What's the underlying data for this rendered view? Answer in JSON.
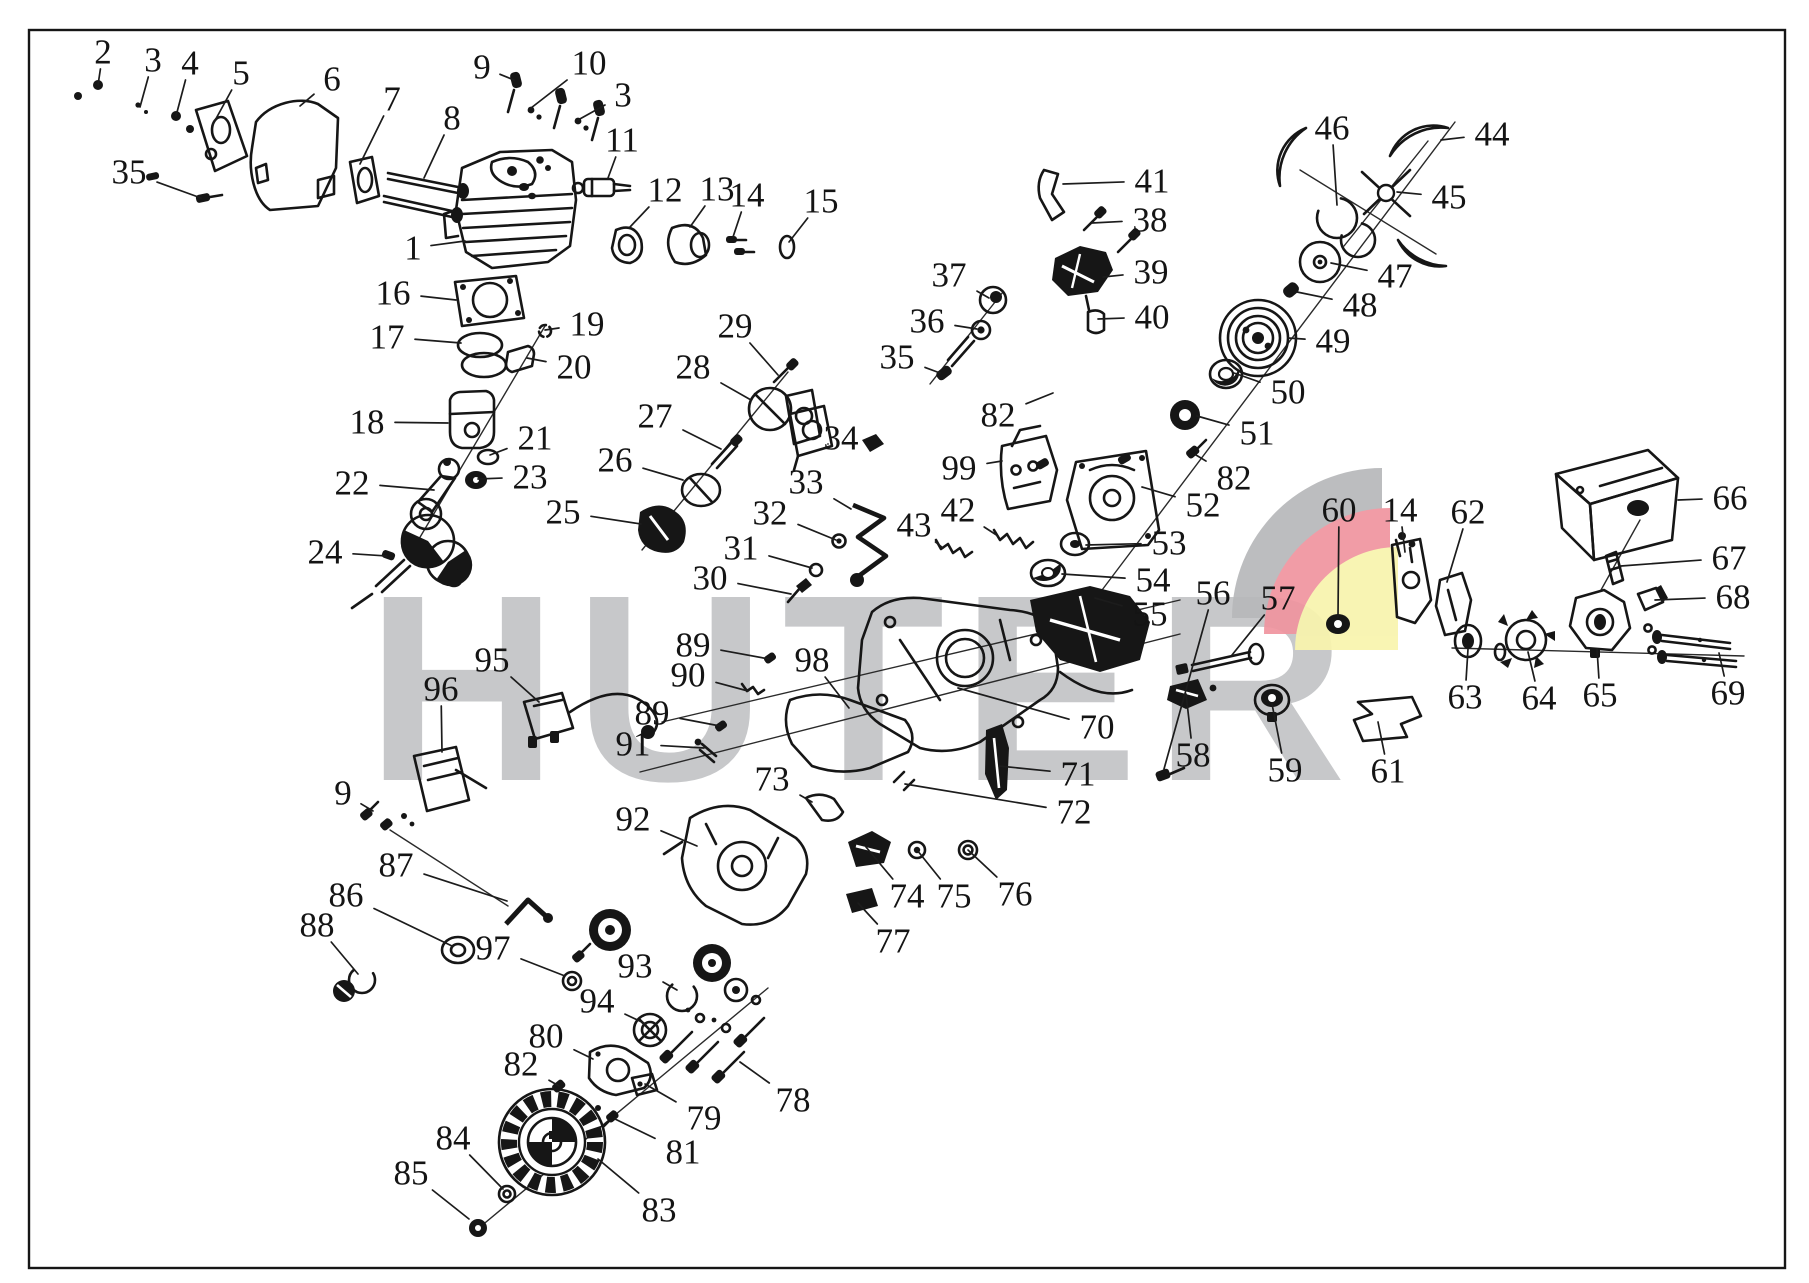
{
  "diagram": {
    "type": "exploded-parts-diagram",
    "subject": "chainsaw engine parts",
    "brand_watermark": "HUTER",
    "colors": {
      "background": "#ffffff",
      "line": "#161616",
      "watermark_gray": "#c7c8ca",
      "logo_gray": "#b7b8ba",
      "logo_red": "#f0949f",
      "logo_yellow": "#f8f4ad"
    },
    "labels": [
      {
        "n": "2",
        "x": 103,
        "y": 52,
        "tx": 98,
        "ty": 85
      },
      {
        "n": "3",
        "x": 153,
        "y": 60,
        "tx": 140,
        "ty": 107
      },
      {
        "n": "4",
        "x": 190,
        "y": 63,
        "tx": 176,
        "ty": 116
      },
      {
        "n": "5",
        "x": 241,
        "y": 73,
        "tx": 212,
        "ty": 126
      },
      {
        "n": "6",
        "x": 332,
        "y": 79,
        "tx": 300,
        "ty": 106
      },
      {
        "n": "7",
        "x": 392,
        "y": 99,
        "tx": 360,
        "ty": 164
      },
      {
        "n": "8",
        "x": 452,
        "y": 118,
        "tx": 424,
        "ty": 178
      },
      {
        "n": "9",
        "x": 482,
        "y": 67,
        "tx": 514,
        "ty": 80
      },
      {
        "n": "10",
        "x": 589,
        "y": 63,
        "tx": 531,
        "ty": 108
      },
      {
        "n": "3",
        "x": 623,
        "y": 95,
        "tx": 578,
        "ty": 120
      },
      {
        "n": "11",
        "x": 622,
        "y": 140,
        "tx": 608,
        "ty": 178
      },
      {
        "n": "35",
        "x": 129,
        "y": 172,
        "tx": 201,
        "ty": 198
      },
      {
        "n": "1",
        "x": 413,
        "y": 248,
        "tx": 465,
        "ty": 241
      },
      {
        "n": "12",
        "x": 665,
        "y": 190,
        "tx": 630,
        "ty": 227
      },
      {
        "n": "13",
        "x": 717,
        "y": 189,
        "tx": 690,
        "ty": 227
      },
      {
        "n": "14",
        "x": 747,
        "y": 195,
        "tx": 733,
        "ty": 237
      },
      {
        "n": "15",
        "x": 821,
        "y": 201,
        "tx": 789,
        "ty": 242
      },
      {
        "n": "16",
        "x": 393,
        "y": 293,
        "tx": 456,
        "ty": 300
      },
      {
        "n": "17",
        "x": 387,
        "y": 337,
        "tx": 461,
        "ty": 343
      },
      {
        "n": "19",
        "x": 587,
        "y": 324,
        "tx": 545,
        "ty": 330
      },
      {
        "n": "20",
        "x": 574,
        "y": 367,
        "tx": 527,
        "ty": 358
      },
      {
        "n": "18",
        "x": 367,
        "y": 422,
        "tx": 448,
        "ty": 423
      },
      {
        "n": "21",
        "x": 535,
        "y": 438,
        "tx": 490,
        "ty": 455
      },
      {
        "n": "23",
        "x": 530,
        "y": 477,
        "tx": 478,
        "ty": 479
      },
      {
        "n": "22",
        "x": 352,
        "y": 483,
        "tx": 434,
        "ty": 490
      },
      {
        "n": "24",
        "x": 325,
        "y": 552,
        "tx": 387,
        "ty": 556
      },
      {
        "n": "25",
        "x": 563,
        "y": 512,
        "tx": 641,
        "ty": 524
      },
      {
        "n": "26",
        "x": 615,
        "y": 460,
        "tx": 683,
        "ty": 480
      },
      {
        "n": "27",
        "x": 655,
        "y": 416,
        "tx": 721,
        "ty": 449
      },
      {
        "n": "28",
        "x": 693,
        "y": 367,
        "tx": 751,
        "ty": 400
      },
      {
        "n": "29",
        "x": 735,
        "y": 326,
        "tx": 778,
        "ty": 375
      },
      {
        "n": "34",
        "x": 841,
        "y": 438,
        "tx": 828,
        "ty": 444
      },
      {
        "n": "33",
        "x": 806,
        "y": 482,
        "tx": 851,
        "ty": 509
      },
      {
        "n": "32",
        "x": 770,
        "y": 513,
        "tx": 836,
        "ty": 540
      },
      {
        "n": "31",
        "x": 741,
        "y": 548,
        "tx": 812,
        "ty": 568
      },
      {
        "n": "30",
        "x": 710,
        "y": 578,
        "tx": 791,
        "ty": 594
      },
      {
        "n": "43",
        "x": 914,
        "y": 525,
        "tx": 943,
        "ty": 548
      },
      {
        "n": "42",
        "x": 958,
        "y": 510,
        "tx": 998,
        "ty": 536
      },
      {
        "n": "99",
        "x": 959,
        "y": 468,
        "tx": 1002,
        "ty": 461
      },
      {
        "n": "82",
        "x": 998,
        "y": 415,
        "tx": 1053,
        "ty": 393
      },
      {
        "n": "37",
        "x": 949,
        "y": 275,
        "tx": 989,
        "ty": 298
      },
      {
        "n": "36",
        "x": 927,
        "y": 321,
        "tx": 977,
        "ty": 329
      },
      {
        "n": "35",
        "x": 897,
        "y": 357,
        "tx": 940,
        "ty": 373
      },
      {
        "n": "41",
        "x": 1152,
        "y": 181,
        "tx": 1063,
        "ty": 184
      },
      {
        "n": "38",
        "x": 1150,
        "y": 220,
        "tx": 1092,
        "ty": 223
      },
      {
        "n": "39",
        "x": 1151,
        "y": 272,
        "tx": 1103,
        "ty": 277
      },
      {
        "n": "40",
        "x": 1152,
        "y": 317,
        "tx": 1098,
        "ty": 319
      },
      {
        "n": "46",
        "x": 1332,
        "y": 128,
        "tx": 1337,
        "ty": 205
      },
      {
        "n": "44",
        "x": 1492,
        "y": 134,
        "tx": 1441,
        "ty": 140
      },
      {
        "n": "45",
        "x": 1449,
        "y": 197,
        "tx": 1397,
        "ty": 192
      },
      {
        "n": "47",
        "x": 1395,
        "y": 276,
        "tx": 1331,
        "ty": 263
      },
      {
        "n": "48",
        "x": 1360,
        "y": 305,
        "tx": 1297,
        "ty": 292
      },
      {
        "n": "49",
        "x": 1333,
        "y": 341,
        "tx": 1288,
        "ty": 338
      },
      {
        "n": "50",
        "x": 1288,
        "y": 392,
        "tx": 1234,
        "ty": 373
      },
      {
        "n": "51",
        "x": 1257,
        "y": 433,
        "tx": 1197,
        "ty": 416
      },
      {
        "n": "82",
        "x": 1234,
        "y": 478,
        "tx": 1196,
        "ty": 455
      },
      {
        "n": "52",
        "x": 1203,
        "y": 505,
        "tx": 1142,
        "ty": 487
      },
      {
        "n": "53",
        "x": 1169,
        "y": 543,
        "tx": 1086,
        "ty": 545
      },
      {
        "n": "54",
        "x": 1153,
        "y": 580,
        "tx": 1062,
        "ty": 574
      },
      {
        "n": "55",
        "x": 1150,
        "y": 614,
        "tx": 1095,
        "ty": 598
      },
      {
        "n": "56",
        "x": 1213,
        "y": 593,
        "tx": 1164,
        "ty": 769
      },
      {
        "n": "57",
        "x": 1278,
        "y": 598,
        "tx": 1232,
        "ty": 655
      },
      {
        "n": "60",
        "x": 1339,
        "y": 510,
        "tx": 1338,
        "ty": 617
      },
      {
        "n": "14",
        "x": 1400,
        "y": 510,
        "tx": 1405,
        "ty": 552
      },
      {
        "n": "62",
        "x": 1468,
        "y": 512,
        "tx": 1447,
        "ty": 582
      },
      {
        "n": "66",
        "x": 1730,
        "y": 498,
        "tx": 1678,
        "ty": 500
      },
      {
        "n": "67",
        "x": 1729,
        "y": 558,
        "tx": 1621,
        "ty": 566
      },
      {
        "n": "68",
        "x": 1733,
        "y": 597,
        "tx": 1655,
        "ty": 600
      },
      {
        "n": "69",
        "x": 1728,
        "y": 693,
        "tx": 1719,
        "ty": 653
      },
      {
        "n": "65",
        "x": 1600,
        "y": 695,
        "tx": 1597,
        "ty": 649
      },
      {
        "n": "64",
        "x": 1539,
        "y": 698,
        "tx": 1528,
        "ty": 652
      },
      {
        "n": "63",
        "x": 1465,
        "y": 697,
        "tx": 1468,
        "ty": 649
      },
      {
        "n": "61",
        "x": 1388,
        "y": 771,
        "tx": 1378,
        "ty": 722
      },
      {
        "n": "59",
        "x": 1285,
        "y": 770,
        "tx": 1272,
        "ty": 704
      },
      {
        "n": "58",
        "x": 1193,
        "y": 755,
        "tx": 1186,
        "ty": 694
      },
      {
        "n": "70",
        "x": 1097,
        "y": 727,
        "tx": 958,
        "ty": 688
      },
      {
        "n": "71",
        "x": 1078,
        "y": 774,
        "tx": 999,
        "ty": 766
      },
      {
        "n": "72",
        "x": 1074,
        "y": 812,
        "tx": 905,
        "ty": 784
      },
      {
        "n": "89",
        "x": 693,
        "y": 645,
        "tx": 769,
        "ty": 659
      },
      {
        "n": "98",
        "x": 812,
        "y": 660,
        "tx": 849,
        "ty": 708
      },
      {
        "n": "90",
        "x": 688,
        "y": 675,
        "tx": 748,
        "ty": 691
      },
      {
        "n": "89",
        "x": 652,
        "y": 713,
        "tx": 720,
        "ty": 726
      },
      {
        "n": "91",
        "x": 633,
        "y": 744,
        "tx": 704,
        "ty": 748
      },
      {
        "n": "95",
        "x": 492,
        "y": 660,
        "tx": 539,
        "ty": 702
      },
      {
        "n": "96",
        "x": 441,
        "y": 689,
        "tx": 442,
        "ty": 752
      },
      {
        "n": "9",
        "x": 343,
        "y": 793,
        "tx": 373,
        "ty": 811
      },
      {
        "n": "73",
        "x": 772,
        "y": 779,
        "tx": 812,
        "ty": 802
      },
      {
        "n": "92",
        "x": 633,
        "y": 819,
        "tx": 697,
        "ty": 846
      },
      {
        "n": "87",
        "x": 396,
        "y": 865,
        "tx": 507,
        "ty": 901
      },
      {
        "n": "86",
        "x": 346,
        "y": 895,
        "tx": 452,
        "ty": 946
      },
      {
        "n": "88",
        "x": 317,
        "y": 925,
        "tx": 358,
        "ty": 974
      },
      {
        "n": "97",
        "x": 493,
        "y": 948,
        "tx": 565,
        "ty": 976
      },
      {
        "n": "93",
        "x": 635,
        "y": 966,
        "tx": 677,
        "ty": 990
      },
      {
        "n": "94",
        "x": 597,
        "y": 1001,
        "tx": 646,
        "ty": 1024
      },
      {
        "n": "74",
        "x": 907,
        "y": 896,
        "tx": 866,
        "ty": 847
      },
      {
        "n": "75",
        "x": 954,
        "y": 896,
        "tx": 917,
        "ty": 850
      },
      {
        "n": "76",
        "x": 1015,
        "y": 894,
        "tx": 968,
        "ty": 850
      },
      {
        "n": "77",
        "x": 893,
        "y": 941,
        "tx": 858,
        "ty": 903
      },
      {
        "n": "80",
        "x": 546,
        "y": 1036,
        "tx": 593,
        "ty": 1059
      },
      {
        "n": "82",
        "x": 521,
        "y": 1064,
        "tx": 559,
        "ty": 1086
      },
      {
        "n": "78",
        "x": 793,
        "y": 1100,
        "tx": 740,
        "ty": 1062
      },
      {
        "n": "79",
        "x": 704,
        "y": 1118,
        "tx": 645,
        "ty": 1084
      },
      {
        "n": "81",
        "x": 683,
        "y": 1152,
        "tx": 615,
        "ty": 1119
      },
      {
        "n": "84",
        "x": 453,
        "y": 1138,
        "tx": 503,
        "ty": 1189
      },
      {
        "n": "85",
        "x": 411,
        "y": 1173,
        "tx": 469,
        "ty": 1219
      },
      {
        "n": "83",
        "x": 659,
        "y": 1210,
        "tx": 598,
        "ty": 1159
      }
    ]
  }
}
